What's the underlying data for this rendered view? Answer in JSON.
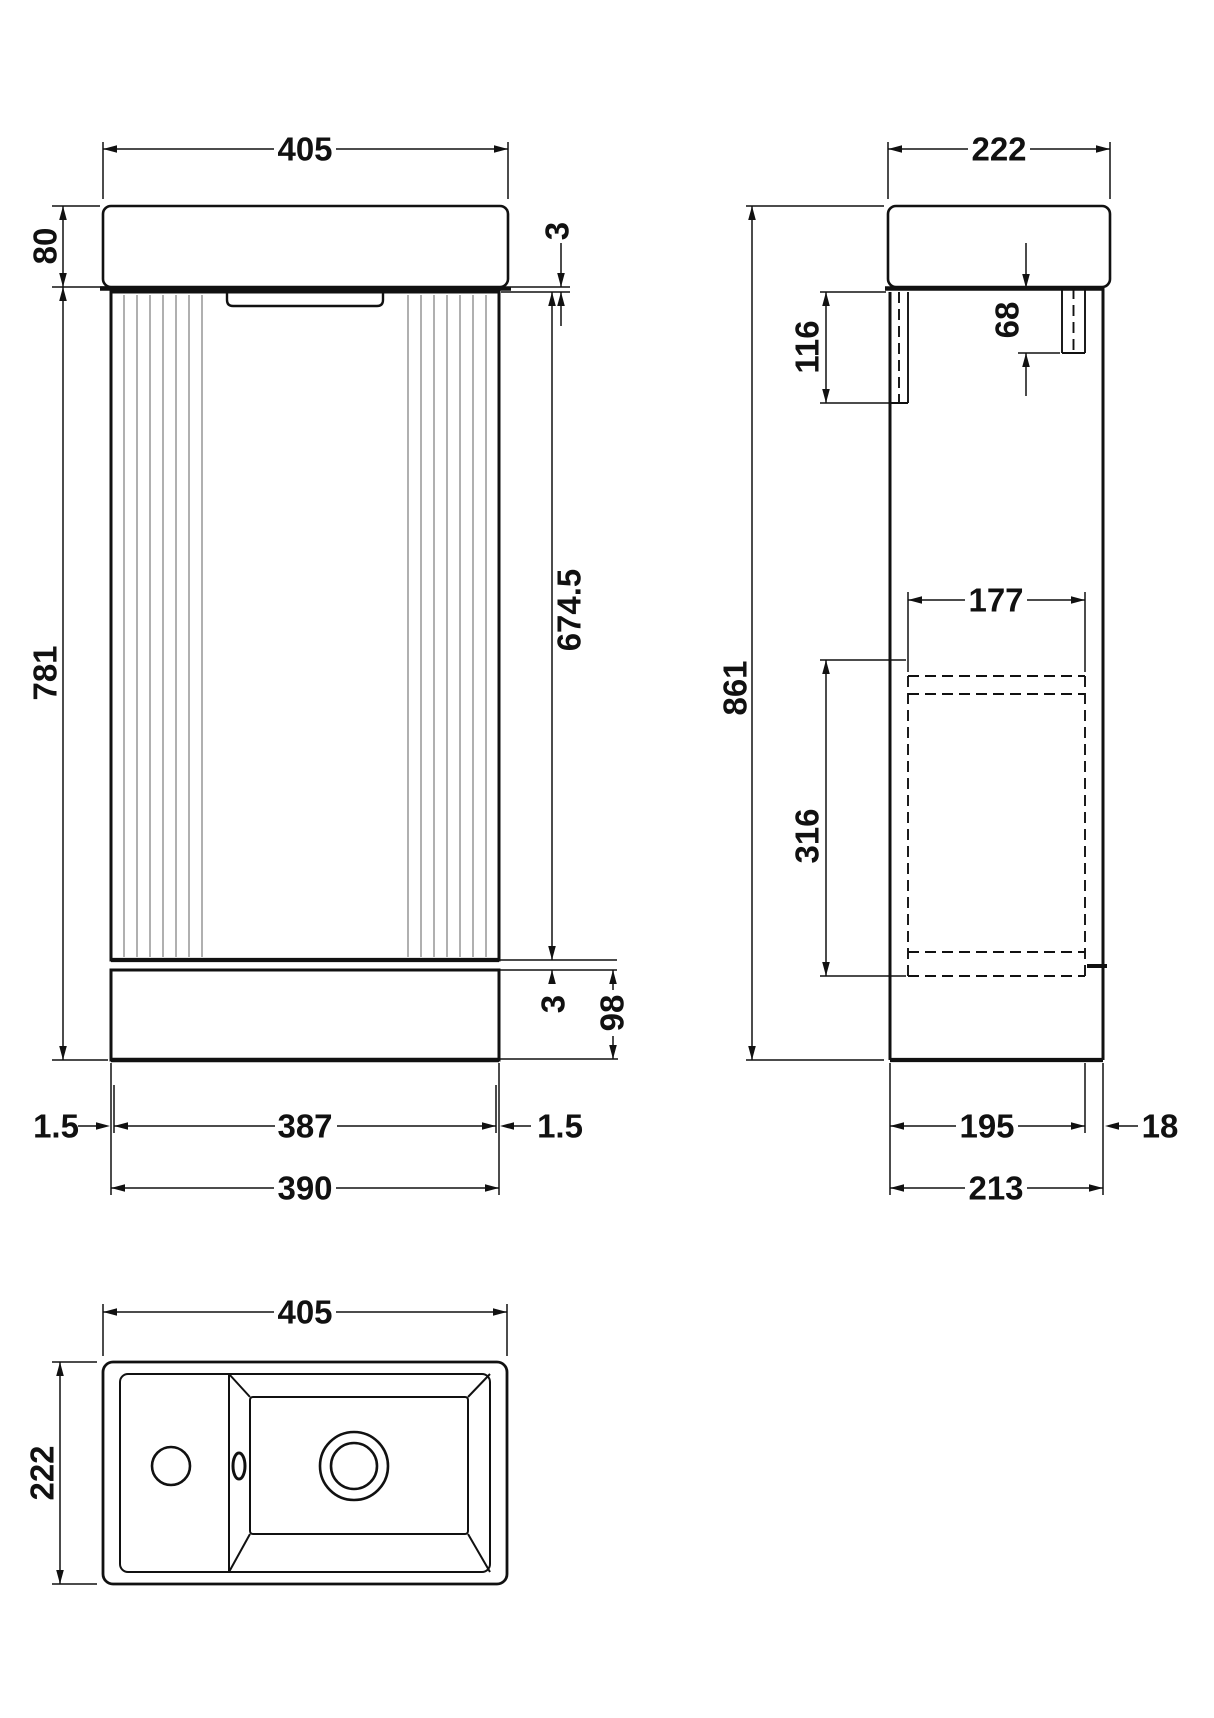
{
  "front": {
    "width_top": "405",
    "basin_height": "80",
    "top_gap": "3",
    "cabinet_height": "781",
    "door_height": "674.5",
    "bottom_gap": "3",
    "plinth_height": "98",
    "left_reveal": "1.5",
    "door_width": "387",
    "right_reveal": "1.5",
    "cabinet_width": "390"
  },
  "side": {
    "depth_top": "222",
    "total_height": "861",
    "front_bracket_height": "116",
    "back_bracket_height": "68",
    "internal_width": "177",
    "internal_height": "316",
    "body_depth": "195",
    "back_gap": "18",
    "total_depth": "213"
  },
  "plan": {
    "width": "405",
    "depth": "222"
  },
  "colors": {
    "line": "#111111",
    "flute": "#8f8f8f",
    "background": "#ffffff"
  }
}
